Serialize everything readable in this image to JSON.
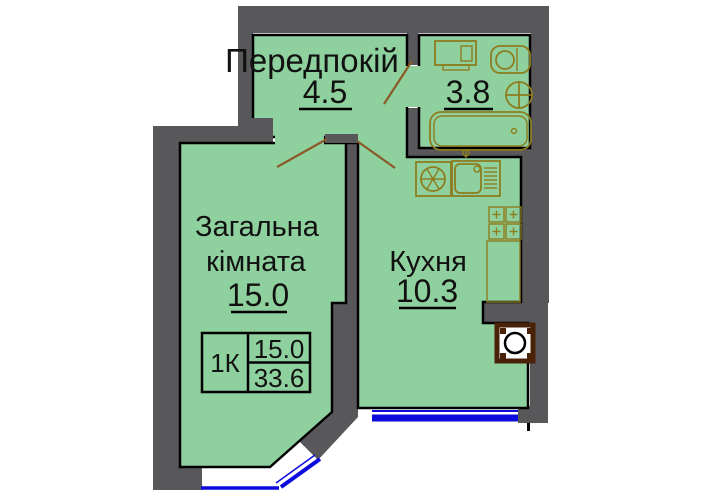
{
  "colors": {
    "wall": "#58585a",
    "room_fill": "#8fd19e",
    "outline": "#000000",
    "fixture": "#8d7d1f",
    "door": "#8a5a28",
    "window": "#0b0bdd",
    "vent": "#4a2208",
    "text": "#111111",
    "background": "#ffffff"
  },
  "rooms": {
    "hallway": {
      "name": "Передпокій",
      "area": "4.5"
    },
    "bathroom": {
      "area": "3.8"
    },
    "living": {
      "name_line1": "Загальна",
      "name_line2": "кімната",
      "area": "15.0"
    },
    "kitchen": {
      "name": "Кухня",
      "area": "10.3"
    }
  },
  "legend": {
    "apartment_type": "1К",
    "living_area": "15.0",
    "total_area": "33.6"
  },
  "fixtures": [
    "washing-machine",
    "toilet",
    "washbasin",
    "bathtub",
    "fan-unit",
    "kitchen-sink",
    "faucet",
    "stove",
    "fridge-space",
    "vent-shaft"
  ]
}
